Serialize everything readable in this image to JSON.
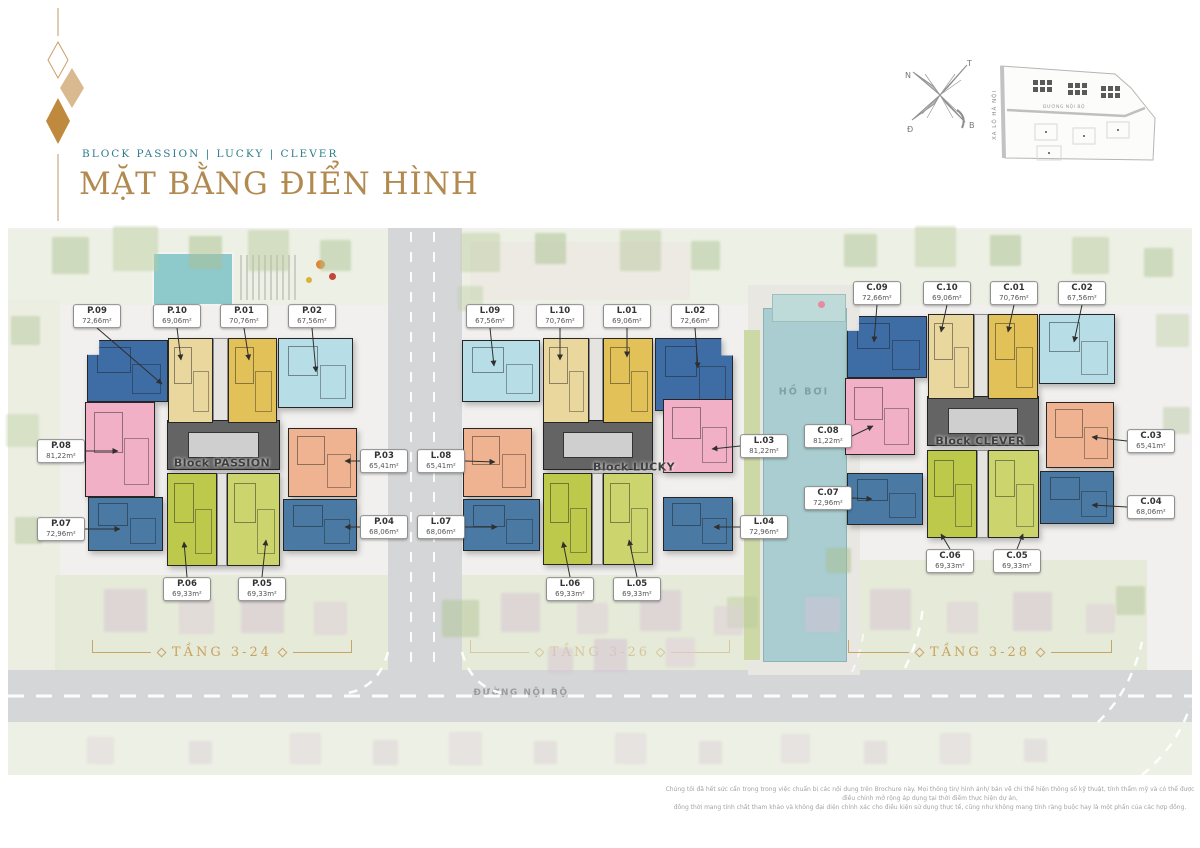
{
  "header": {
    "tagline": "BLOCK PASSION | LUCKY | CLEVER",
    "title": "MẶT BẰNG ĐIỂN HÌNH"
  },
  "compass": {
    "top_left": "N",
    "top_right": "T",
    "bottom_left": "Đ",
    "bottom_right": "B"
  },
  "site_map": {
    "highway_label": "XA LỘ HÀ NỘI",
    "road_label": "ĐƯỜNG NỘI BỘ"
  },
  "plan": {
    "pool_label": "HỒ BƠI",
    "road_label": "ĐƯỜNG NỘI BỘ",
    "blocks": [
      {
        "name": "Block PASSION",
        "floors_label": "TẦNG 3-24",
        "units": [
          {
            "code": "P.01",
            "area": "70,76m²"
          },
          {
            "code": "P.02",
            "area": "67,56m²"
          },
          {
            "code": "P.03",
            "area": "65,41m²"
          },
          {
            "code": "P.04",
            "area": "68,06m²"
          },
          {
            "code": "P.05",
            "area": "69,33m²"
          },
          {
            "code": "P.06",
            "area": "69,33m²"
          },
          {
            "code": "P.07",
            "area": "72,96m²"
          },
          {
            "code": "P.08",
            "area": "81,22m²"
          },
          {
            "code": "P.09",
            "area": "72,66m²"
          },
          {
            "code": "P.10",
            "area": "69,06m²"
          }
        ]
      },
      {
        "name": "Block LUCKY",
        "floors_label": "TẦNG 3-26",
        "units": [
          {
            "code": "L.01",
            "area": "69,06m²"
          },
          {
            "code": "L.02",
            "area": "72,66m²"
          },
          {
            "code": "L.03",
            "area": "81,22m²"
          },
          {
            "code": "L.04",
            "area": "72,96m²"
          },
          {
            "code": "L.05",
            "area": "69,33m²"
          },
          {
            "code": "L.06",
            "area": "69,33m²"
          },
          {
            "code": "L.07",
            "area": "68,06m²"
          },
          {
            "code": "L.08",
            "area": "65,41m²"
          },
          {
            "code": "L.09",
            "area": "67,56m²"
          },
          {
            "code": "L.10",
            "area": "70,76m²"
          }
        ]
      },
      {
        "name": "Block CLEVER",
        "floors_label": "TẦNG 3-28",
        "units": [
          {
            "code": "C.01",
            "area": "70,76m²"
          },
          {
            "code": "C.02",
            "area": "67,56m²"
          },
          {
            "code": "C.03",
            "area": "65,41m²"
          },
          {
            "code": "C.04",
            "area": "68,06m²"
          },
          {
            "code": "C.05",
            "area": "69,33m²"
          },
          {
            "code": "C.06",
            "area": "69,33m²"
          },
          {
            "code": "C.07",
            "area": "72,96m²"
          },
          {
            "code": "C.08",
            "area": "81,22m²"
          },
          {
            "code": "C.09",
            "area": "72,66m²"
          },
          {
            "code": "C.10",
            "area": "69,06m²"
          }
        ]
      }
    ]
  },
  "footer": {
    "line1": "Chúng tôi đã hết sức cẩn trọng trong việc chuẩn bị các nội dung trên Brochure này. Mọi thông tin/ hình ảnh/ bản vẽ chỉ thể hiện thông số kỹ thuật, tính thẩm mỹ và có thể được điều chỉnh mở rộng áp dụng tại thời điểm thực hiện dự án,",
    "line2": "đồng thời mang tính chất tham khảo và không đại diện chính xác cho điều kiện sử dụng thực tế, cũng như không mang tính ràng buộc hay là một phần của các hợp đồng."
  },
  "palette": {
    "title_gold": "#b28a50",
    "tagline_teal": "#2b7d8c",
    "floors_gold": "#c8a25e",
    "unit_navy": "#3e6da6",
    "unit_cream": "#e9d79e",
    "unit_gold": "#e3c159",
    "unit_sky": "#b7dde7",
    "unit_pink": "#f2b0c7",
    "unit_steel": "#4a79a4",
    "unit_salmon": "#f0b392",
    "unit_lime": "#bcc94b",
    "pool_teal": "#a9cdd0"
  }
}
